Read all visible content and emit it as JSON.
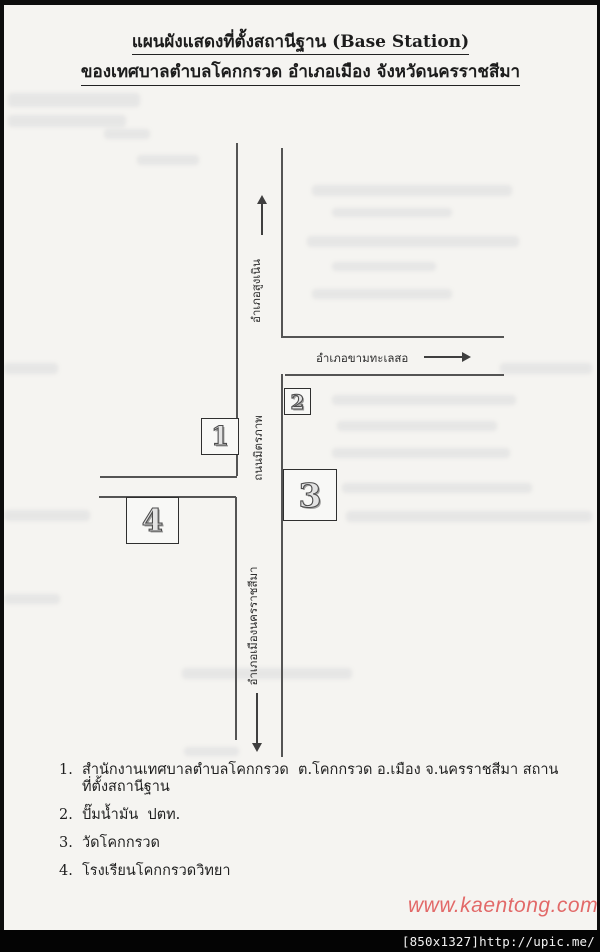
{
  "document": {
    "title_line1": "แผนผังแสดงที่ตั้งสถานีฐาน (Base Station)",
    "title_line2": "ของเทศบาลตำบลโคกกรวด อำเภอเมือง จังหวัดนครราชสีมา"
  },
  "map": {
    "labels": {
      "top_destination": "อำเภอสูงเนิน",
      "road_name": "ถนนมิตรภาพ",
      "bottom_destination": "อำเภอเมืองนครราชสีมา",
      "branch_destination": "อำเภอขามทะเลสอ"
    },
    "markers": [
      {
        "number": "1"
      },
      {
        "number": "2"
      },
      {
        "number": "3"
      },
      {
        "number": "4"
      }
    ]
  },
  "legend": {
    "items": [
      {
        "no": "1.",
        "text": "สำนักงานเทศบาลตำบลโคกกรวด  ต.โคกกรวด อ.เมือง จ.นครราชสีมา สถานที่ตั้งสถานีฐาน"
      },
      {
        "no": "2.",
        "text": "ปั๊มน้ำมัน  ปตท."
      },
      {
        "no": "3.",
        "text": "วัดโคกกรวด"
      },
      {
        "no": "4.",
        "text": "โรงเรียนโคกกรวดวิทยา"
      }
    ]
  },
  "watermark": {
    "text": "www.kaentong.com",
    "color": "#e05a5a"
  },
  "status_bar": {
    "resolution_label": "[850x1327]",
    "url": "http://upic.me/"
  },
  "colors": {
    "paper": "#f5f4f1",
    "ink": "#1c1c1c",
    "road_line": "#545454",
    "bar_bg": "#040404"
  }
}
